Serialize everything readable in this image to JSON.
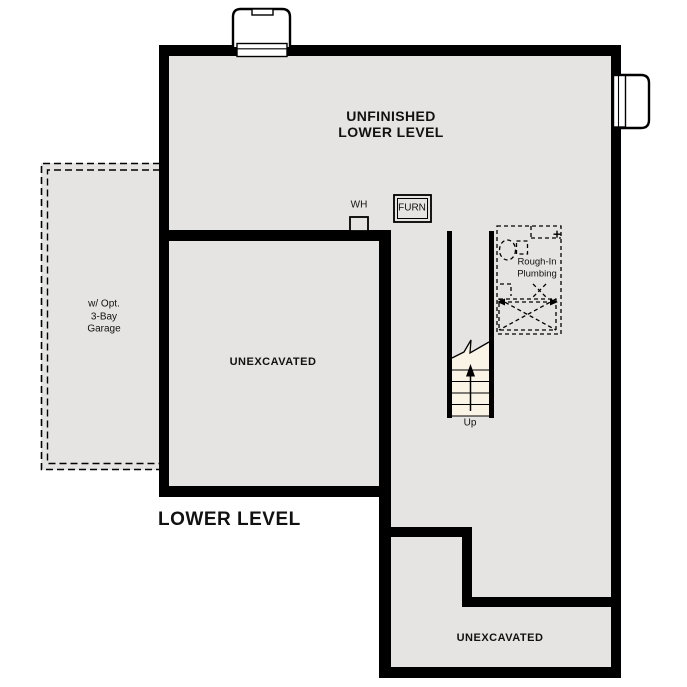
{
  "plan": {
    "title": "LOWER LEVEL",
    "colors": {
      "floor": "#e5e4e2",
      "wall": "#000000",
      "stair": "#faf4e6",
      "ink": "#111111",
      "background": "#ffffff"
    },
    "rooms": {
      "main_line1": "UNFINISHED",
      "main_line2": "LOWER LEVEL",
      "unexcavated_middle": "UNEXCAVATED",
      "unexcavated_bottom": "UNEXCAVATED"
    },
    "fixtures": {
      "water_heater": "WH",
      "furnace": "FURN",
      "plumbing_line1": "Rough-In",
      "plumbing_line2": "Plumbing"
    },
    "stairs": {
      "up": "Up"
    },
    "garage": {
      "line1": "w/ Opt.",
      "line2": "3-Bay",
      "line3": "Garage"
    }
  }
}
